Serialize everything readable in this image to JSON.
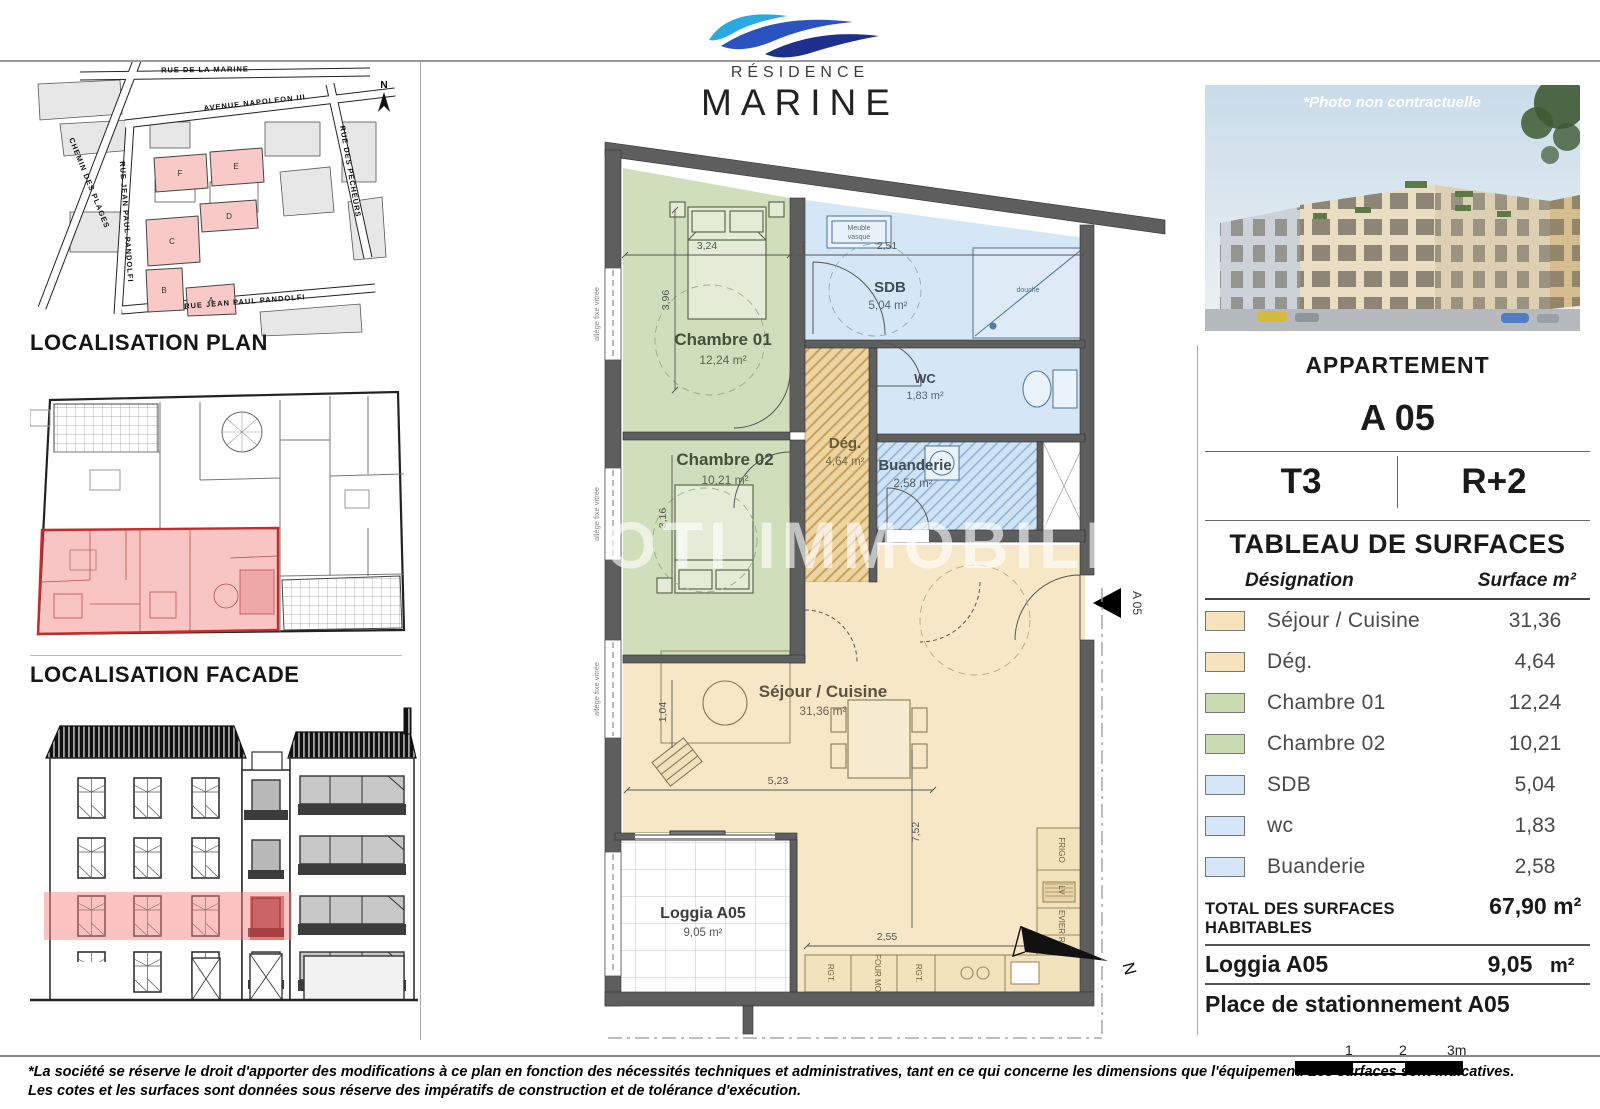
{
  "logo": {
    "residence": "Résidence",
    "marine": "MARINE"
  },
  "left": {
    "plan_title": "LOCALISATION PLAN",
    "facade_title": "LOCALISATION FACADE",
    "map": {
      "north": "N",
      "streets": {
        "marine": "RUE DE LA MARINE",
        "napoleon": "AVENUE NAPOLEON III",
        "plages": "CHEMIN DES PLAGES",
        "pandolfi_v": "RUE JEAN PAUL PANDOLFI",
        "pandolfi_h": "RUE JEAN PAUL PANDOLFI",
        "pecheurs": "RUE DES PECHEURS"
      },
      "blocks": {
        "a": "A",
        "b": "B",
        "c": "C",
        "d": "D",
        "e": "E",
        "f": "F"
      }
    }
  },
  "photo": {
    "caption": "*Photo non contractuelle"
  },
  "plan": {
    "watermark": "OTI IMMOBILI",
    "entrance_label": "A 05",
    "north": "N",
    "window_label": "allège fixe vitrée",
    "rooms": {
      "chambre1": {
        "name": "Chambre 01",
        "area": "12,24 m²"
      },
      "chambre2": {
        "name": "Chambre 02",
        "area": "10,21 m²"
      },
      "sdb": {
        "name": "SDB",
        "area": "5,04 m²"
      },
      "wc": {
        "name": "WC",
        "area": "1,83 m²"
      },
      "buanderie": {
        "name": "Buanderie",
        "area": "2,58 m²"
      },
      "deg": {
        "name": "Dég.",
        "area": "4,64 m²"
      },
      "sejour": {
        "name": "Séjour / Cuisine",
        "area": "31,36 m²"
      },
      "loggia": {
        "name": "Loggia A05",
        "area": "9,05 m²"
      }
    },
    "dims": {
      "w_ch1": "3,24",
      "gap": "7",
      "w_sdb": "2,51",
      "h_ch1": "3,96",
      "h_ch2": "3,16",
      "w_arm": "1,04",
      "w_sej": "5,23",
      "h_sej": "7,52",
      "w_kitchen": "2,55"
    },
    "kitchen": {
      "frigo": "FRIGO",
      "lv": "LV",
      "evier": "EVIER",
      "rgt_r": "RGT.",
      "rgt_b1": "RGT.",
      "four": "FOUR MO",
      "rgt_b2": "RGT."
    },
    "sdb_fixtures": {
      "meuble1": "Meuble",
      "meuble2": "vasque",
      "douche": "douche"
    },
    "colors": {
      "tan": "#f6e8c6",
      "tan_hatch": "#edd5a2",
      "green": "#cfdebb",
      "blue": "#d5e7f6",
      "wall": "#5e5e5e",
      "highlight_pink": "#f4928f"
    }
  },
  "panel": {
    "appartement_label": "APPARTEMENT",
    "unit": "A 05",
    "type": "T3",
    "floor": "R+2",
    "table_title": "TABLEAU DE SURFACES",
    "col_designation": "Désignation",
    "col_surface": "Surface m²",
    "rows": [
      {
        "label": "Séjour / Cuisine",
        "value": "31,36",
        "color": "#f6e3bb"
      },
      {
        "label": "Dég.",
        "value": "4,64",
        "color": "#f6e3bb"
      },
      {
        "label": "Chambre 01",
        "value": "12,24",
        "color": "#cadbb1"
      },
      {
        "label": "Chambre 02",
        "value": "10,21",
        "color": "#cadbb1"
      },
      {
        "label": "SDB",
        "value": "5,04",
        "color": "#d4e6f7"
      },
      {
        "label": "wc",
        "value": "1,83",
        "color": "#d4e6f7"
      },
      {
        "label": "Buanderie",
        "value": "2,58",
        "color": "#d4e6f7"
      }
    ],
    "total_label": "TOTAL DES SURFACES HABITABLES",
    "total_value": "67,90 m²",
    "loggia_label": "Loggia A05",
    "loggia_value": "9,05",
    "loggia_unit": "m²",
    "parking_label": "Place de stationnement A05",
    "scale": {
      "t1": "1",
      "t2": "2",
      "t3": "3m"
    }
  },
  "footer": {
    "line1": "*La société se réserve le droit d'apporter des modifications à ce plan en fonction des nécessités techniques et administratives, tant en ce qui concerne les dimensions que l'équipement. Les surfaces sont indicatives.",
    "line2": "Les cotes et les surfaces sont données sous réserve des impératifs de construction et de tolérance d'exécution."
  }
}
